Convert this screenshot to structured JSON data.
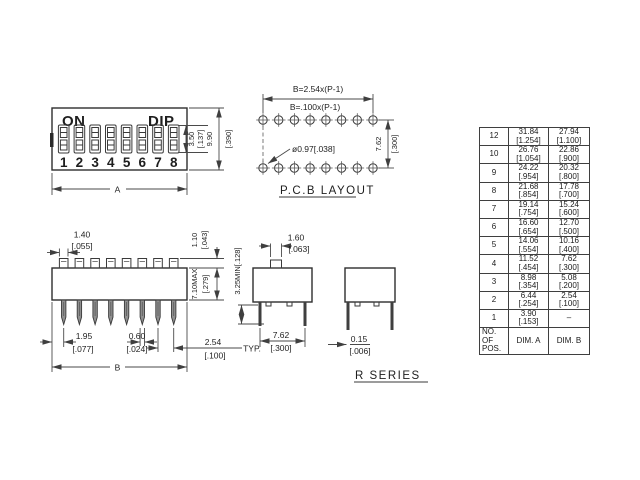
{
  "front_view": {
    "on_label": "ON",
    "dip_label": "DIP",
    "switch_numbers": [
      "1",
      "2",
      "3",
      "4",
      "5",
      "6",
      "7",
      "8"
    ],
    "dim_slot_mm": "3.50",
    "dim_slot_in": "[.137]",
    "dim_height_mm": "9.90",
    "dim_height_in": "[.390]",
    "dim_width_label": "A"
  },
  "pcb_layout": {
    "title": "P.C.B  LAYOUT",
    "dim_b_metric": "B=2.54x(P-1)",
    "dim_b_imperial": "B=.100x(P-1)",
    "hole_callout": "ø0.97[.038]",
    "dim_row_mm": "7.62",
    "dim_row_in": "[.300]"
  },
  "side_view": {
    "dim_actuator_w_mm": "1.40",
    "dim_actuator_w_in": "[.055]",
    "dim_actuator_h_mm": "1.10",
    "dim_actuator_h_in": "[.043]",
    "dim_body_h_mm": "7.10MAX",
    "dim_body_h_in": "[.279]",
    "dim_pin_offset_mm": "1.95",
    "dim_pin_offset_in": "[.077]",
    "dim_pin_w_mm": "0.60",
    "dim_pin_w_in": "[.024]",
    "dim_pitch_mm": "2.54",
    "dim_pitch_in": "[.100]",
    "dim_pitch_note": "TYP.",
    "dim_width_label": "B"
  },
  "end_view": {
    "dim_actuator_mm": "1.60",
    "dim_actuator_in": "[.063]",
    "dim_pin_len": "3.25MIN[.128]",
    "dim_row_mm": "7.62",
    "dim_row_in": "[.300]",
    "dim_pin_t_mm": "0.15",
    "dim_pin_t_in": "[.006]"
  },
  "series_label": "R  SERIES",
  "table": {
    "header_pos_l1": "NO. OF",
    "header_pos_l2": "POS.",
    "header_a": "DIM. A",
    "header_b": "DIM. B",
    "rows": [
      {
        "pos": "12",
        "a_mm": "31.84",
        "a_in": "[1.254]",
        "b_mm": "27.94",
        "b_in": "[1.100]"
      },
      {
        "pos": "10",
        "a_mm": "26.76",
        "a_in": "[1.054]",
        "b_mm": "22.86",
        "b_in": "[.900]"
      },
      {
        "pos": "9",
        "a_mm": "24.22",
        "a_in": "[.954]",
        "b_mm": "20.32",
        "b_in": "[.800]"
      },
      {
        "pos": "8",
        "a_mm": "21.68",
        "a_in": "[.854]",
        "b_mm": "17.78",
        "b_in": "[.700]"
      },
      {
        "pos": "7",
        "a_mm": "19.14",
        "a_in": "[.754]",
        "b_mm": "15.24",
        "b_in": "[.600]"
      },
      {
        "pos": "6",
        "a_mm": "16.60",
        "a_in": "[.654]",
        "b_mm": "12.70",
        "b_in": "[.500]"
      },
      {
        "pos": "5",
        "a_mm": "14.06",
        "a_in": "[.554]",
        "b_mm": "10.16",
        "b_in": "[.400]"
      },
      {
        "pos": "4",
        "a_mm": "11.52",
        "a_in": "[.454]",
        "b_mm": "7.62",
        "b_in": "[.300]"
      },
      {
        "pos": "3",
        "a_mm": "8.98",
        "a_in": "[.354]",
        "b_mm": "5.08",
        "b_in": "[.200]"
      },
      {
        "pos": "2",
        "a_mm": "6.44",
        "a_in": "[.254]",
        "b_mm": "2.54",
        "b_in": "[.100]"
      },
      {
        "pos": "1",
        "a_mm": "3.90",
        "a_in": "[.153]",
        "b_mm": "–",
        "b_in": ""
      }
    ]
  }
}
